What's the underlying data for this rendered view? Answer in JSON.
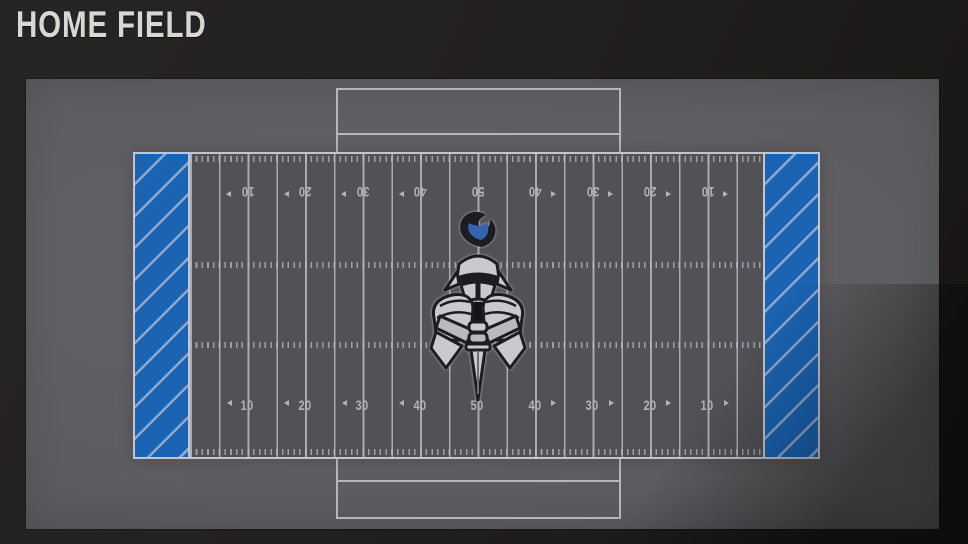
{
  "header": {
    "title": "HOME FIELD"
  },
  "field_preview": {
    "yard_numbers_top": [
      "10",
      "20",
      "30",
      "40",
      "50",
      "40",
      "30",
      "20",
      "10"
    ],
    "yard_numbers_bottom": [
      "10",
      "20",
      "30",
      "40",
      "50",
      "40",
      "30",
      "20",
      "10"
    ],
    "colors": {
      "endzone_blue": "#1b64b4",
      "endzone_stripe": "#8fa9cb",
      "turf_gray": "#525156",
      "line_white": "#c6c5cb",
      "number_gray": "#b4b3ba"
    },
    "logo": {
      "icon": "knight-sword-crest-icon",
      "plume_color": "#3563b0",
      "armor_color": "#c9c9cf",
      "outline_color": "#1d1d21"
    }
  }
}
